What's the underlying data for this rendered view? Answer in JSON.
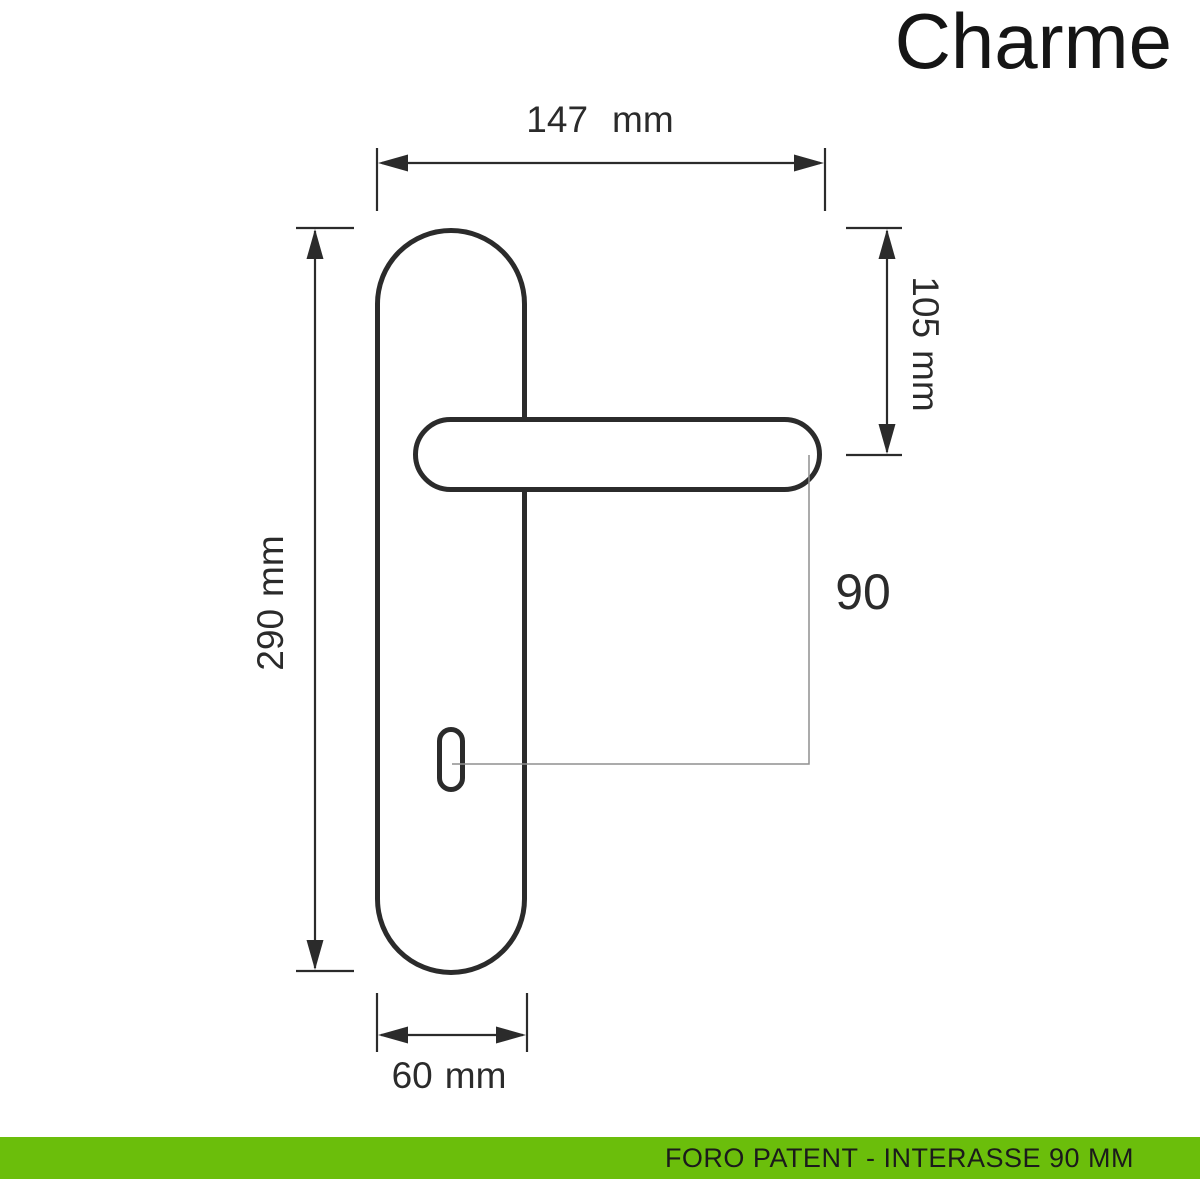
{
  "title": "Charme",
  "drawing": {
    "dimensions": {
      "overall_width": {
        "value": "147",
        "unit": "mm"
      },
      "handle_to_top": {
        "value": "105",
        "unit": "mm"
      },
      "plate_height": {
        "value": "290",
        "unit": "mm"
      },
      "plate_width": {
        "value": "60",
        "unit": "mm"
      },
      "interaxis": {
        "value": "90"
      }
    }
  },
  "footer": {
    "label": "FORO PATENT - INTERASSE 90 MM"
  },
  "colors": {
    "bar_green": "#6BBE0B",
    "line_dark": "#2B2B2B",
    "thin_line_gray": "#8F8F8F",
    "text_black": "#1B1B1B"
  }
}
